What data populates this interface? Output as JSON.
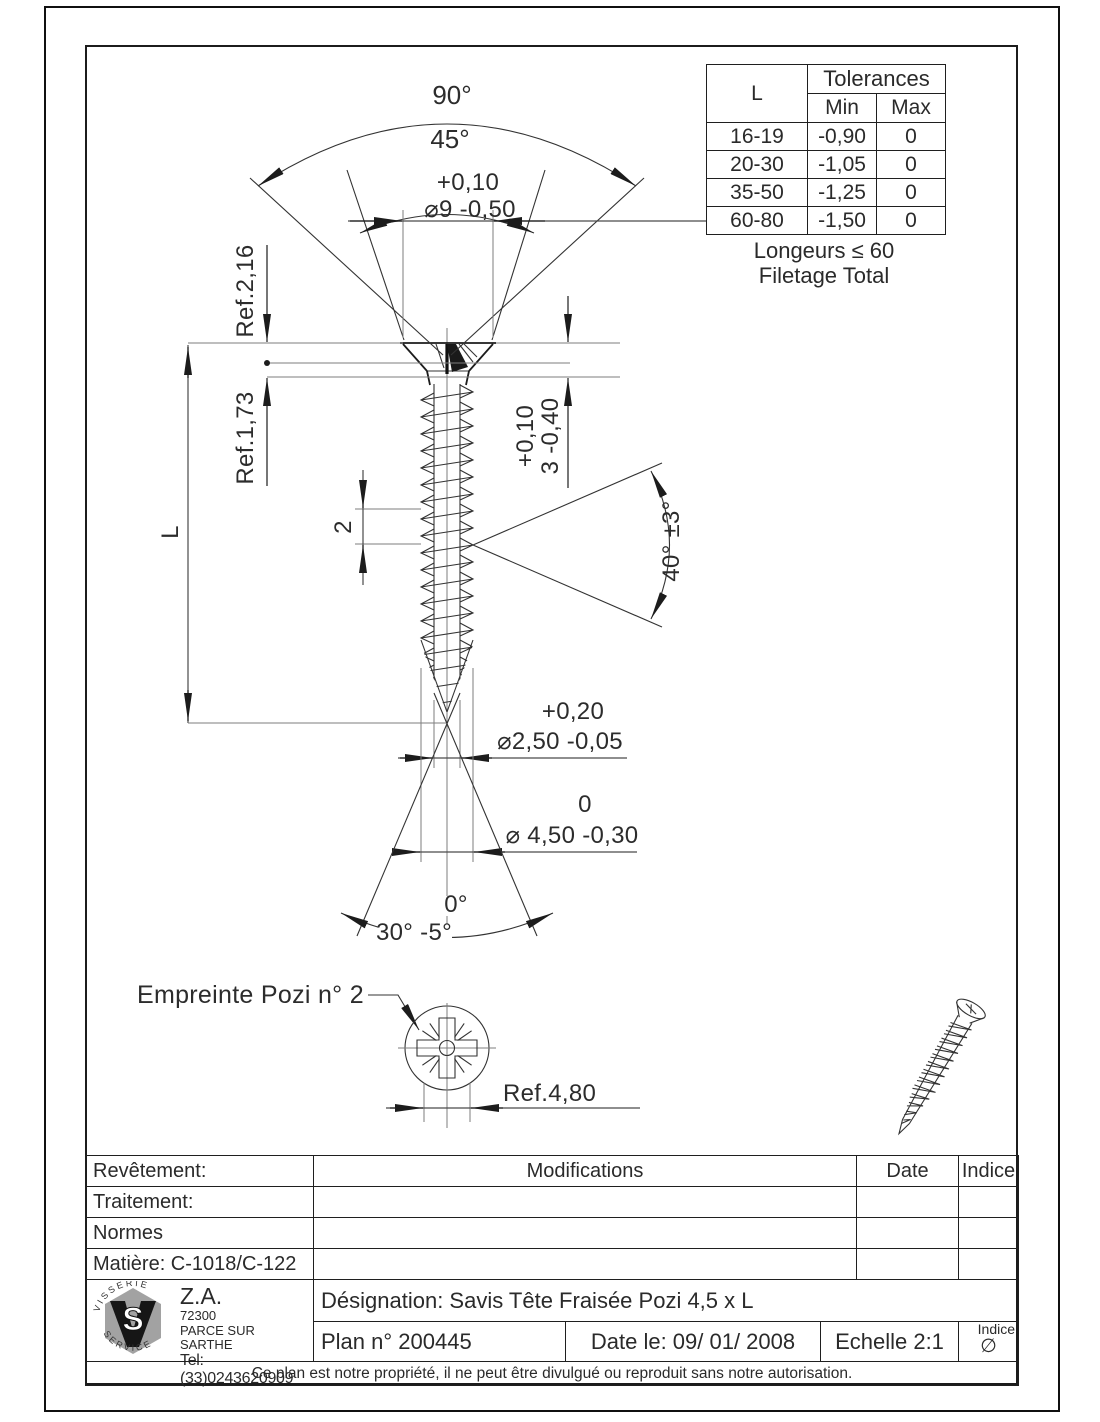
{
  "drawing": {
    "angles": {
      "outer": "90°",
      "inner": "45°",
      "thread": "40° ±3°",
      "tip_nominal": "0°",
      "tip": "30° -5°"
    },
    "dims": {
      "head_dia_plus": "+0,10",
      "head_dia": "⌀9 -0,50",
      "ref_head": "Ref.2,16",
      "ref_neck": "Ref.1,73",
      "length": "L",
      "pitch": "2",
      "head_h_plus": "+0,10",
      "head_h": "3 -0,40",
      "core_dia_plus": "+0,20",
      "core_dia": "⌀2,50 -0,05",
      "outer_dia_plus": "0",
      "outer_dia": "⌀ 4,50 -0,30",
      "recess": "Ref.4,80"
    },
    "pozi_label": "Empreinte Pozi n° 2"
  },
  "tolerances": {
    "l_header": "L",
    "title": "Tolerances",
    "min": "Min",
    "max": "Max",
    "rows": [
      {
        "l": "16-19",
        "min": "-0,90",
        "max": "0"
      },
      {
        "l": "20-30",
        "min": "-1,05",
        "max": "0"
      },
      {
        "l": "35-50",
        "min": "-1,25",
        "max": "0"
      },
      {
        "l": "60-80",
        "min": "-1,50",
        "max": "0"
      }
    ],
    "note1": "Longeurs ≤ 60",
    "note2": "Filetage Total"
  },
  "titleblock": {
    "revetement": "Revêtement:",
    "traitement": "Traitement:",
    "normes": "Normes",
    "matiere": "Matière: C-1018/C-122",
    "modifications": "Modifications",
    "date": "Date",
    "indice": "Indice",
    "company": {
      "za": "Z.A.",
      "zip": "72300",
      "city": "PARCE SUR SARTHE",
      "tel": "Tel:(33)0243620909",
      "ring_top": "V I S S E R I E",
      "ring_bottom": "S E R V I C E",
      "monogram": "S"
    },
    "designation": "Désignation: Savis Tête Fraisée Pozi  4,5 x L",
    "plan": "Plan n° 200445",
    "date_le": "Date le: 09/ 01/ 2008",
    "echelle": "Echelle 2:1",
    "indice_label": "Indice",
    "indice_value": "∅",
    "notice": "Ce plan est notre propriété, il ne peut être divulgué ou reproduit sans notre autorisation."
  }
}
